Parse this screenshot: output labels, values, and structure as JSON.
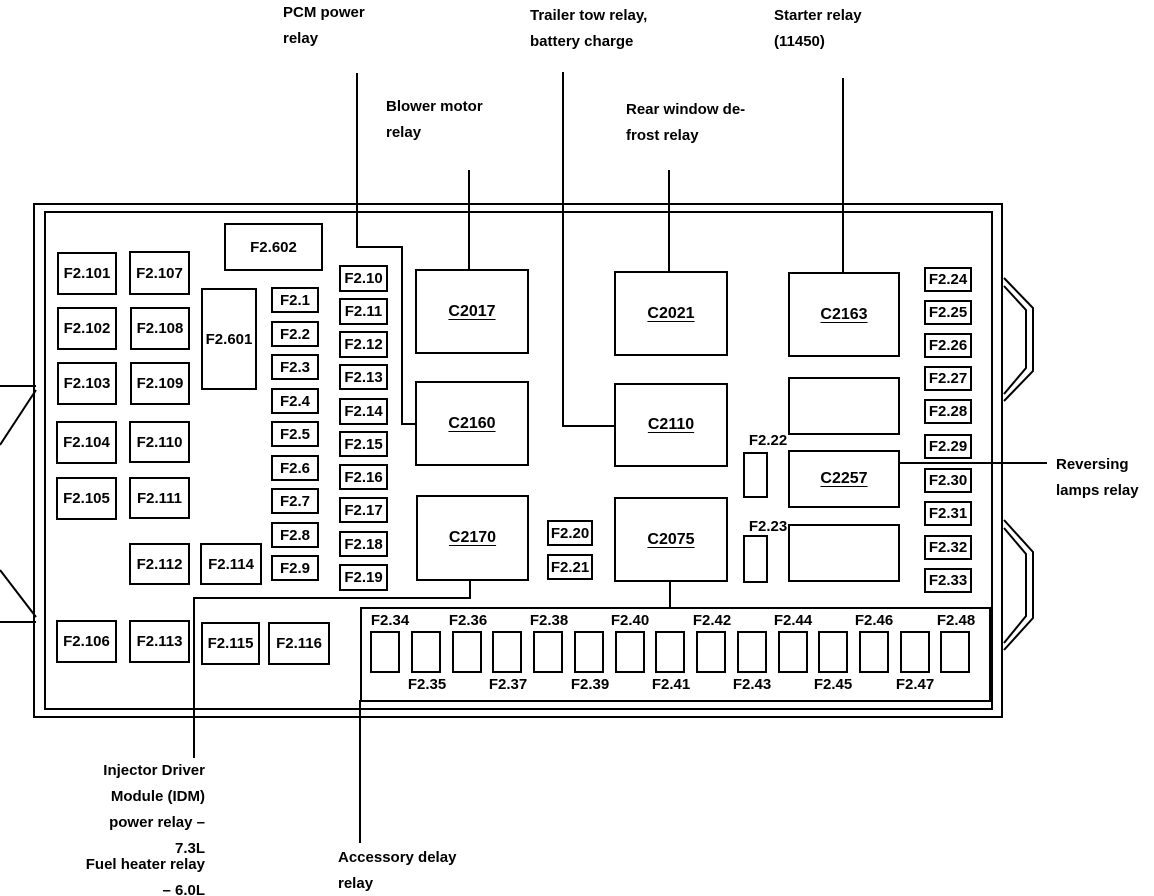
{
  "annotations": [
    {
      "id": "pcm-power-relay",
      "lines": [
        "PCM power",
        "relay"
      ],
      "x": 283,
      "y": 0,
      "align": "left"
    },
    {
      "id": "blower-motor-relay",
      "lines": [
        "Blower motor",
        "relay"
      ],
      "x": 386,
      "y": 94,
      "align": "left"
    },
    {
      "id": "trailer-tow-relay",
      "lines": [
        "Trailer tow relay,",
        "battery charge"
      ],
      "x": 530,
      "y": 3,
      "align": "left"
    },
    {
      "id": "rear-window-defrost-relay",
      "lines": [
        "Rear window de-",
        "frost relay"
      ],
      "x": 626,
      "y": 97,
      "align": "left"
    },
    {
      "id": "starter-relay",
      "lines": [
        "Starter relay",
        "(11450)"
      ],
      "x": 774,
      "y": 3,
      "align": "left"
    },
    {
      "id": "reversing-lamps-relay",
      "lines": [
        "Reversing",
        "lamps relay"
      ],
      "x": 1056,
      "y": 452,
      "align": "left"
    },
    {
      "id": "idm-power-relay",
      "lines": [
        "Injector Driver",
        "Module (IDM)",
        "power relay –",
        "7.3L"
      ],
      "x": 60,
      "y": 758,
      "width": 145,
      "align": "right"
    },
    {
      "id": "fuel-heater-relay",
      "lines": [
        "Fuel heater relay",
        "– 6.0L"
      ],
      "x": 60,
      "y": 852,
      "width": 145,
      "align": "right"
    },
    {
      "id": "accessory-delay-relay",
      "lines": [
        "Accessory delay",
        "relay"
      ],
      "x": 338,
      "y": 845,
      "align": "left"
    }
  ],
  "boxes": [
    {
      "label": "F2.101",
      "x": 57,
      "y": 252,
      "w": 60,
      "h": 43
    },
    {
      "label": "F2.102",
      "x": 57,
      "y": 307,
      "w": 60,
      "h": 43
    },
    {
      "label": "F2.103",
      "x": 57,
      "y": 362,
      "w": 60,
      "h": 43
    },
    {
      "label": "F2.104",
      "x": 56,
      "y": 421,
      "w": 61,
      "h": 43
    },
    {
      "label": "F2.105",
      "x": 56,
      "y": 477,
      "w": 61,
      "h": 43
    },
    {
      "label": "F2.106",
      "x": 56,
      "y": 620,
      "w": 61,
      "h": 43
    },
    {
      "label": "F2.107",
      "x": 129,
      "y": 251,
      "w": 61,
      "h": 44
    },
    {
      "label": "F2.108",
      "x": 130,
      "y": 307,
      "w": 60,
      "h": 43
    },
    {
      "label": "F2.109",
      "x": 130,
      "y": 362,
      "w": 60,
      "h": 43
    },
    {
      "label": "F2.110",
      "x": 129,
      "y": 421,
      "w": 61,
      "h": 42
    },
    {
      "label": "F2.111",
      "x": 129,
      "y": 477,
      "w": 61,
      "h": 42
    },
    {
      "label": "F2.112",
      "x": 129,
      "y": 543,
      "w": 61,
      "h": 42
    },
    {
      "label": "F2.113",
      "x": 129,
      "y": 620,
      "w": 61,
      "h": 43
    },
    {
      "label": "F2.114",
      "x": 200,
      "y": 543,
      "w": 62,
      "h": 42
    },
    {
      "label": "F2.115",
      "x": 201,
      "y": 622,
      "w": 59,
      "h": 43
    },
    {
      "label": "F2.116",
      "x": 268,
      "y": 622,
      "w": 62,
      "h": 43
    },
    {
      "label": "F2.601",
      "x": 201,
      "y": 288,
      "w": 56,
      "h": 102
    },
    {
      "label": "F2.602",
      "x": 224,
      "y": 223,
      "w": 99,
      "h": 48
    },
    {
      "label": "F2.1",
      "x": 271,
      "y": 287,
      "w": 48,
      "h": 26
    },
    {
      "label": "F2.2",
      "x": 271,
      "y": 321,
      "w": 48,
      "h": 26
    },
    {
      "label": "F2.3",
      "x": 271,
      "y": 354,
      "w": 48,
      "h": 26
    },
    {
      "label": "F2.4",
      "x": 271,
      "y": 388,
      "w": 48,
      "h": 26
    },
    {
      "label": "F2.5",
      "x": 271,
      "y": 421,
      "w": 48,
      "h": 26
    },
    {
      "label": "F2.6",
      "x": 271,
      "y": 455,
      "w": 48,
      "h": 26
    },
    {
      "label": "F2.7",
      "x": 271,
      "y": 488,
      "w": 48,
      "h": 26
    },
    {
      "label": "F2.8",
      "x": 271,
      "y": 522,
      "w": 48,
      "h": 26
    },
    {
      "label": "F2.9",
      "x": 271,
      "y": 555,
      "w": 48,
      "h": 26
    },
    {
      "label": "F2.10",
      "x": 339,
      "y": 265,
      "w": 49,
      "h": 27
    },
    {
      "label": "F2.11",
      "x": 339,
      "y": 298,
      "w": 49,
      "h": 27
    },
    {
      "label": "F2.12",
      "x": 339,
      "y": 331,
      "w": 49,
      "h": 27
    },
    {
      "label": "F2.13",
      "x": 339,
      "y": 364,
      "w": 49,
      "h": 26
    },
    {
      "label": "F2.14",
      "x": 339,
      "y": 398,
      "w": 49,
      "h": 27
    },
    {
      "label": "F2.15",
      "x": 339,
      "y": 431,
      "w": 49,
      "h": 26
    },
    {
      "label": "F2.16",
      "x": 339,
      "y": 464,
      "w": 49,
      "h": 26
    },
    {
      "label": "F2.17",
      "x": 339,
      "y": 497,
      "w": 49,
      "h": 26
    },
    {
      "label": "F2.18",
      "x": 339,
      "y": 531,
      "w": 49,
      "h": 26
    },
    {
      "label": "F2.19",
      "x": 339,
      "y": 564,
      "w": 49,
      "h": 27
    },
    {
      "label": "C2017",
      "x": 415,
      "y": 269,
      "w": 114,
      "h": 85,
      "type": "connector"
    },
    {
      "label": "C2160",
      "x": 415,
      "y": 381,
      "w": 114,
      "h": 85,
      "type": "connector"
    },
    {
      "label": "C2170",
      "x": 416,
      "y": 495,
      "w": 113,
      "h": 86,
      "type": "connector"
    },
    {
      "label": "C2021",
      "x": 614,
      "y": 271,
      "w": 114,
      "h": 85,
      "type": "connector"
    },
    {
      "label": "C2110",
      "x": 614,
      "y": 383,
      "w": 114,
      "h": 84,
      "type": "connector"
    },
    {
      "label": "C2075",
      "x": 614,
      "y": 497,
      "w": 114,
      "h": 85,
      "type": "connector"
    },
    {
      "label": "C2163",
      "x": 788,
      "y": 272,
      "w": 112,
      "h": 85,
      "type": "connector"
    },
    {
      "name": "blank-box-1",
      "x": 788,
      "y": 377,
      "w": 112,
      "h": 58
    },
    {
      "label": "C2257",
      "x": 788,
      "y": 450,
      "w": 112,
      "h": 58,
      "type": "connector"
    },
    {
      "name": "blank-box-2",
      "x": 788,
      "y": 524,
      "w": 112,
      "h": 58
    },
    {
      "label": "F2.20",
      "x": 547,
      "y": 520,
      "w": 46,
      "h": 26
    },
    {
      "label": "F2.21",
      "x": 547,
      "y": 554,
      "w": 46,
      "h": 26
    },
    {
      "name": "fuse-box-F2.22",
      "x": 743,
      "y": 452,
      "w": 25,
      "h": 46
    },
    {
      "name": "fuse-box-F2.23",
      "x": 743,
      "y": 535,
      "w": 25,
      "h": 48
    },
    {
      "label": "F2.24",
      "x": 924,
      "y": 267,
      "w": 48,
      "h": 25
    },
    {
      "label": "F2.25",
      "x": 924,
      "y": 300,
      "w": 48,
      "h": 25
    },
    {
      "label": "F2.26",
      "x": 924,
      "y": 333,
      "w": 48,
      "h": 25
    },
    {
      "label": "F2.27",
      "x": 924,
      "y": 366,
      "w": 48,
      "h": 25
    },
    {
      "label": "F2.28",
      "x": 924,
      "y": 399,
      "w": 48,
      "h": 25
    },
    {
      "label": "F2.29",
      "x": 924,
      "y": 434,
      "w": 48,
      "h": 25
    },
    {
      "label": "F2.30",
      "x": 924,
      "y": 468,
      "w": 48,
      "h": 25
    },
    {
      "label": "F2.31",
      "x": 924,
      "y": 501,
      "w": 48,
      "h": 25
    },
    {
      "label": "F2.32",
      "x": 924,
      "y": 535,
      "w": 48,
      "h": 25
    },
    {
      "label": "F2.33",
      "x": 924,
      "y": 568,
      "w": 48,
      "h": 25
    },
    {
      "name": "fuse-slot-F2.34",
      "x": 370,
      "y": 631,
      "w": 30,
      "h": 42
    },
    {
      "name": "fuse-slot-F2.35",
      "x": 411,
      "y": 631,
      "w": 30,
      "h": 42
    },
    {
      "name": "fuse-slot-F2.36",
      "x": 452,
      "y": 631,
      "w": 30,
      "h": 42
    },
    {
      "name": "fuse-slot-F2.37",
      "x": 492,
      "y": 631,
      "w": 30,
      "h": 42
    },
    {
      "name": "fuse-slot-F2.38",
      "x": 533,
      "y": 631,
      "w": 30,
      "h": 42
    },
    {
      "name": "fuse-slot-F2.39",
      "x": 574,
      "y": 631,
      "w": 30,
      "h": 42
    },
    {
      "name": "fuse-slot-F2.40",
      "x": 615,
      "y": 631,
      "w": 30,
      "h": 42
    },
    {
      "name": "fuse-slot-F2.41",
      "x": 655,
      "y": 631,
      "w": 30,
      "h": 42
    },
    {
      "name": "fuse-slot-F2.42",
      "x": 696,
      "y": 631,
      "w": 30,
      "h": 42
    },
    {
      "name": "fuse-slot-F2.43",
      "x": 737,
      "y": 631,
      "w": 30,
      "h": 42
    },
    {
      "name": "fuse-slot-F2.44",
      "x": 778,
      "y": 631,
      "w": 30,
      "h": 42
    },
    {
      "name": "fuse-slot-F2.45",
      "x": 818,
      "y": 631,
      "w": 30,
      "h": 42
    },
    {
      "name": "fuse-slot-F2.46",
      "x": 859,
      "y": 631,
      "w": 30,
      "h": 42
    },
    {
      "name": "fuse-slot-F2.47",
      "x": 900,
      "y": 631,
      "w": 30,
      "h": 42
    },
    {
      "name": "fuse-slot-F2.48",
      "x": 940,
      "y": 631,
      "w": 30,
      "h": 42
    }
  ],
  "texts": [
    {
      "text": "F2.22",
      "x": 768,
      "y": 432,
      "align": "center"
    },
    {
      "text": "F2.23",
      "x": 768,
      "y": 518,
      "align": "center"
    },
    {
      "text": "F2.34",
      "x": 390,
      "y": 612,
      "align": "center"
    },
    {
      "text": "F2.36",
      "x": 468,
      "y": 612,
      "align": "center"
    },
    {
      "text": "F2.38",
      "x": 549,
      "y": 612,
      "align": "center"
    },
    {
      "text": "F2.40",
      "x": 630,
      "y": 612,
      "align": "center"
    },
    {
      "text": "F2.42",
      "x": 712,
      "y": 612,
      "align": "center"
    },
    {
      "text": "F2.44",
      "x": 793,
      "y": 612,
      "align": "center"
    },
    {
      "text": "F2.46",
      "x": 874,
      "y": 612,
      "align": "center"
    },
    {
      "text": "F2.48",
      "x": 956,
      "y": 612,
      "align": "center"
    },
    {
      "text": "F2.35",
      "x": 427,
      "y": 676,
      "align": "center"
    },
    {
      "text": "F2.37",
      "x": 508,
      "y": 676,
      "align": "center"
    },
    {
      "text": "F2.39",
      "x": 590,
      "y": 676,
      "align": "center"
    },
    {
      "text": "F2.41",
      "x": 671,
      "y": 676,
      "align": "center"
    },
    {
      "text": "F2.43",
      "x": 752,
      "y": 676,
      "align": "center"
    },
    {
      "text": "F2.45",
      "x": 833,
      "y": 676,
      "align": "center"
    },
    {
      "text": "F2.47",
      "x": 915,
      "y": 676,
      "align": "center"
    }
  ],
  "lines": [
    {
      "name": "pcm-relay-lead-line",
      "points": "357,73 357,247 402,247 402,424 415,424"
    },
    {
      "name": "blower-relay-lead-line",
      "points": "469,170 469,269"
    },
    {
      "name": "trailer-tow-lead-line",
      "points": "563,72 563,426 614,426"
    },
    {
      "name": "rear-defrost-lead-line",
      "points": "669,170 669,271"
    },
    {
      "name": "starter-relay-lead-line",
      "points": "843,78 843,272"
    },
    {
      "name": "reversing-lamps-lead-line",
      "points": "900,463 1047,463"
    },
    {
      "name": "idm-relay-lead-line",
      "points": "470,581 470,598 194,598 194,758"
    },
    {
      "name": "accessory-relay-lead-line",
      "points": "360,700 360,843"
    },
    {
      "name": "c2075-stub-line",
      "points": "670,582 670,607"
    },
    {
      "name": "left-tab-top-edge",
      "points": "0,386 36,386"
    },
    {
      "name": "left-tab-top-diagonal",
      "points": "36,390 0,445"
    },
    {
      "name": "left-tab-bottom-diagonal",
      "points": "0,570 36,617"
    },
    {
      "name": "left-tab-bottom-edge",
      "points": "0,622 36,622"
    },
    {
      "name": "right-tab-1-outer",
      "points": "1004,278 1033,308 1033,371 1004,401"
    },
    {
      "name": "right-tab-1-inner",
      "points": "1004,286 1026,310 1026,368 1004,394"
    },
    {
      "name": "right-tab-2-outer",
      "points": "1004,520 1033,552 1033,618 1004,650"
    },
    {
      "name": "right-tab-2-inner",
      "points": "1004,528 1026,554 1026,616 1004,643"
    }
  ]
}
